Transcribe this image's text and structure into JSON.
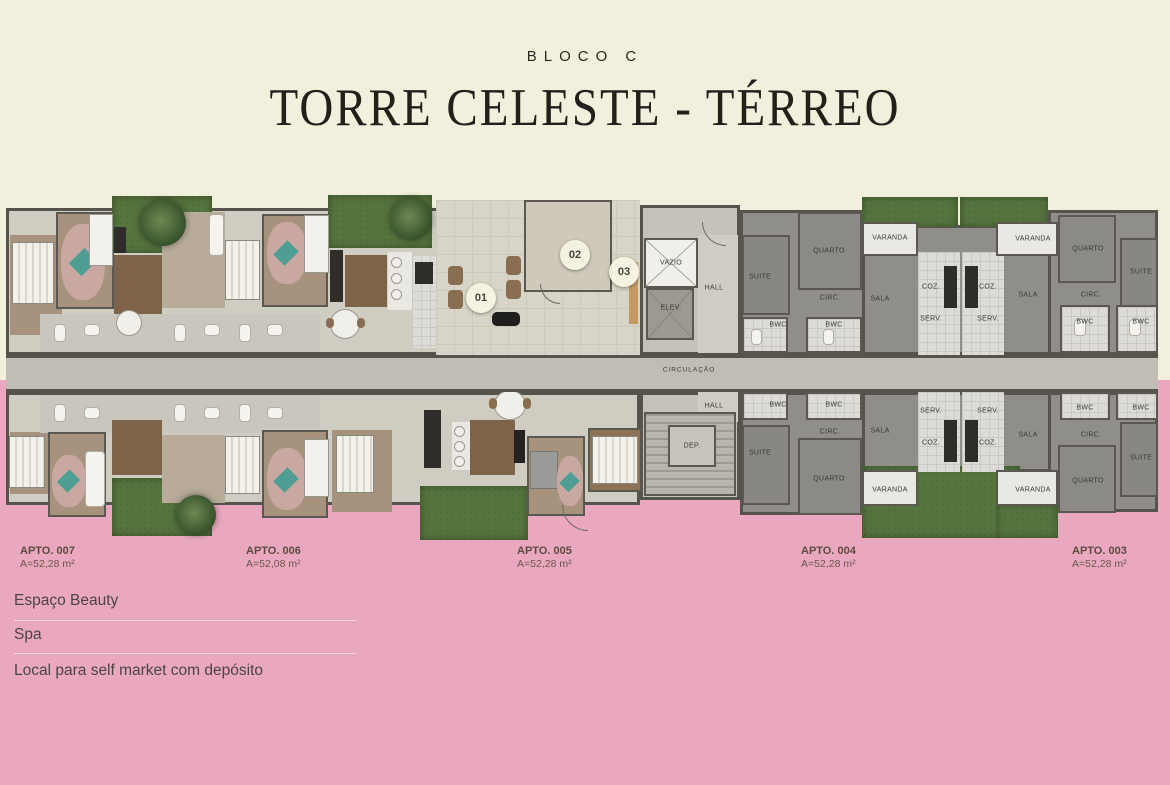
{
  "header": {
    "block_label": "BLOCO C",
    "title": "TORRE CELESTE - TÉRREO"
  },
  "apartments": [
    {
      "id": "APTO. 007",
      "area": "A=52,28 m²"
    },
    {
      "id": "APTO. 006",
      "area": "A=52,08 m²"
    },
    {
      "id": "APTO. 005",
      "area": "A=52,28 m²"
    },
    {
      "id": "APTO. 004",
      "area": "A=52,28 m²"
    },
    {
      "id": "APTO. 003",
      "area": "A=52,28 m²"
    }
  ],
  "amenities": [
    {
      "num": "01",
      "label": "Espaço Beauty"
    },
    {
      "num": "02",
      "label": "Spa"
    },
    {
      "num": "03",
      "label": "Local para self market com depósito"
    }
  ],
  "rooms": {
    "varanda": "VARANDA",
    "quarto": "QUARTO",
    "suite": "SUITE",
    "sala": "SALA",
    "coz": "COZ.",
    "serv": "SERV.",
    "bwc": "BWC",
    "circ": "CIRC.",
    "hall": "HALL",
    "elev": "ELEV.",
    "vazio": "VAZIO",
    "dep": "DEP.",
    "circulacao": "CIRCULAÇÃO"
  },
  "colors": {
    "canvas_top": "#f2efdc",
    "canvas_bottom": "#e9a8c0",
    "grass": "#56743e",
    "plan_gray": "#8f8e8a",
    "badge_bg": "#f5f2e1"
  }
}
